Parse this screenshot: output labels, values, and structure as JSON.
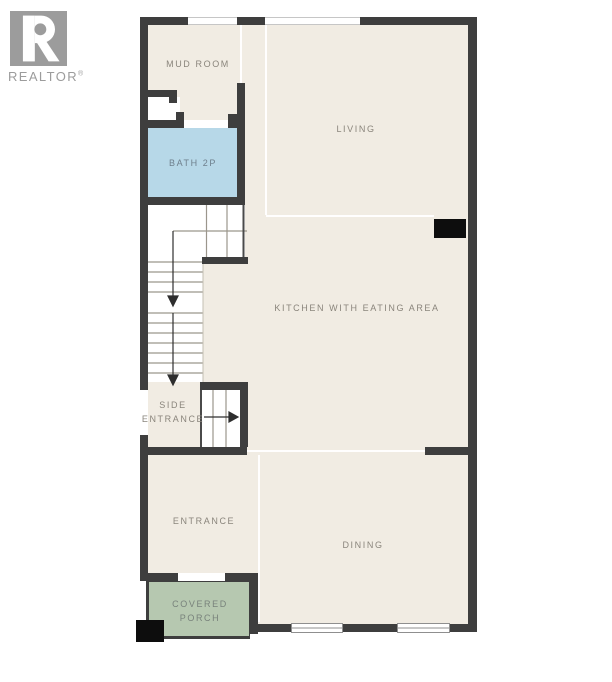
{
  "logo": {
    "letter": "R",
    "wordmark": "REALTOR",
    "registered": "®"
  },
  "colors": {
    "wall": "#3e3e3e",
    "floor": "#f1ece3",
    "bath": "#b7d8e8",
    "porch": "#b6c8b0",
    "label": "#8a857c",
    "bath_label": "#6e7f8c",
    "porch_label": "#78827b",
    "logo_gray": "#9c9c9c",
    "column_black": "#0d0d0d"
  },
  "rooms": {
    "mud_room": {
      "label": "MUD ROOM"
    },
    "living": {
      "label": "LIVING"
    },
    "bath": {
      "label": "BATH 2P"
    },
    "kitchen": {
      "label": "KITCHEN WITH EATING AREA"
    },
    "side_entrance": {
      "line1": "SIDE",
      "line2": "ENTRANCE"
    },
    "entrance": {
      "label": "ENTRANCE"
    },
    "dining": {
      "label": "DINING"
    },
    "covered_porch": {
      "line1": "COVERED",
      "line2": "PORCH"
    }
  }
}
